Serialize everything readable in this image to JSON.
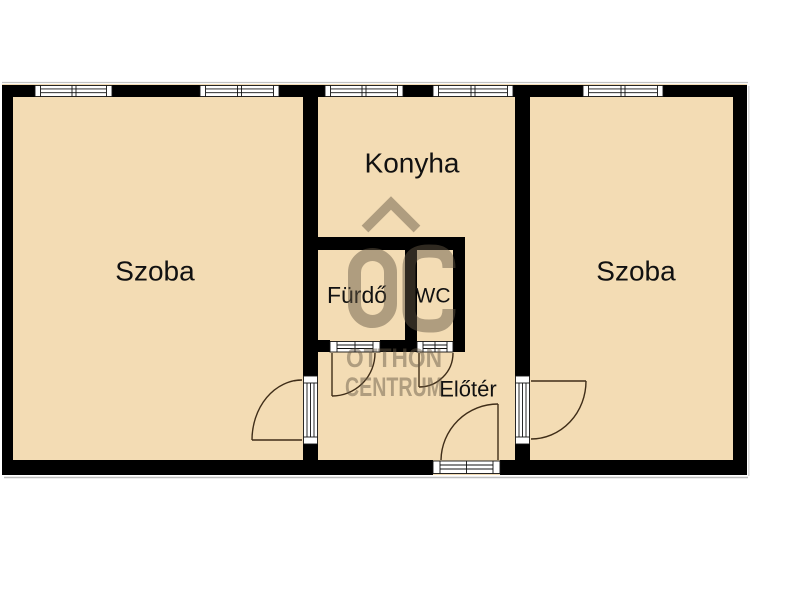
{
  "plan": {
    "type": "apartment-floor-plan",
    "watermark_logo_icon": "oc-roof-logo"
  },
  "colors": {
    "background": "#ffffff",
    "room_fill": "#f3dcb4",
    "wall": "#000000",
    "door_arc": "#3f2d18",
    "watermark": "rgba(100,88,68,0.48)"
  },
  "rooms": {
    "szoba_left": {
      "label": "Szoba"
    },
    "konyha": {
      "label": "Konyha"
    },
    "szoba_right": {
      "label": "Szoba"
    },
    "furdo": {
      "label": "Fürdő"
    },
    "wc": {
      "label": "WC"
    },
    "eloter": {
      "label": "Előtér"
    }
  },
  "watermark": {
    "logo": "OC",
    "line1": "OTTHON",
    "line2": "CENTRUM"
  }
}
